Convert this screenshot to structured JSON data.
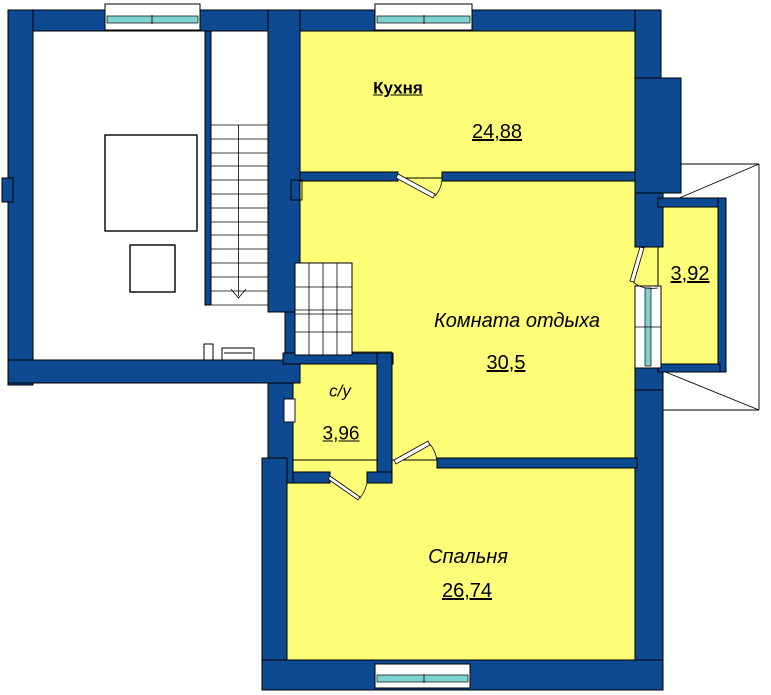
{
  "colors": {
    "wall": "#0d4a91",
    "room_fill": "#fdfd78",
    "glass": "#7fd2d2",
    "outline": "#000000",
    "background": "#ffffff"
  },
  "rooms": {
    "kitchen": {
      "name": "Кухня",
      "area": "24,88"
    },
    "lounge": {
      "name": "Комната отдыха",
      "area": "30,5"
    },
    "bathroom": {
      "name": "с/у",
      "area": "3,96"
    },
    "bedroom": {
      "name": "Спальня",
      "area": "26,74"
    },
    "balcony": {
      "area": "3,92"
    }
  }
}
